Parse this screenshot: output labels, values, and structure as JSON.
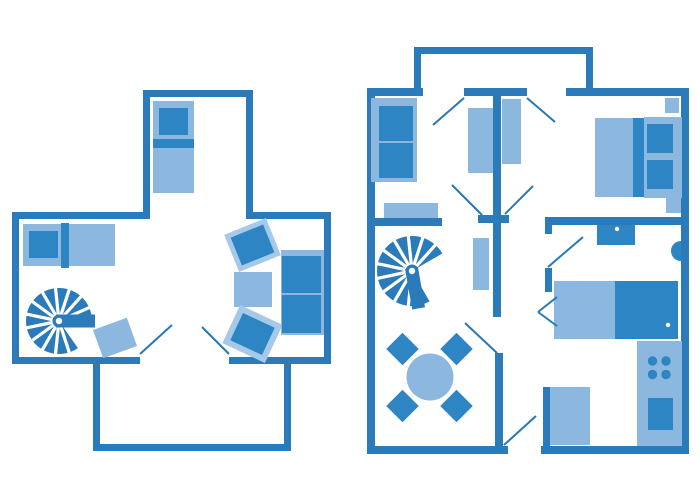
{
  "canvas": {
    "width": 700,
    "height": 500
  },
  "colors": {
    "background": "#ffffff",
    "wall": "#2b7ab9",
    "dark": "#2e85c3",
    "light": "#8cb8df",
    "lighter": "#a6c9e9",
    "line": "#2878b6",
    "white": "#ffffff"
  },
  "plans": [
    {
      "name": "left-unit-plan",
      "elements": [
        {
          "n": "wall-extension-top",
          "k": "wall",
          "x": 143,
          "y": 90,
          "w": 110,
          "h": 7
        },
        {
          "n": "wall-extension-left",
          "k": "wall",
          "x": 143,
          "y": 90,
          "w": 7,
          "h": 128
        },
        {
          "n": "wall-extension-right",
          "k": "wall",
          "x": 246,
          "y": 90,
          "w": 7,
          "h": 128
        },
        {
          "n": "wall-main-top-left",
          "k": "wall",
          "x": 12,
          "y": 212,
          "w": 138,
          "h": 7
        },
        {
          "n": "wall-main-top-right",
          "k": "wall",
          "x": 246,
          "y": 212,
          "w": 84,
          "h": 7
        },
        {
          "n": "wall-main-left",
          "k": "wall",
          "x": 12,
          "y": 212,
          "w": 7,
          "h": 152
        },
        {
          "n": "wall-main-right",
          "k": "wall",
          "x": 324,
          "y": 212,
          "w": 7,
          "h": 152
        },
        {
          "n": "wall-main-bottom-left",
          "k": "wall",
          "x": 12,
          "y": 357,
          "w": 128,
          "h": 7
        },
        {
          "n": "wall-main-bottom-right",
          "k": "wall",
          "x": 229,
          "y": 357,
          "w": 102,
          "h": 7
        },
        {
          "n": "wall-balcony-left",
          "k": "wall",
          "x": 93,
          "y": 357,
          "w": 7,
          "h": 94
        },
        {
          "n": "wall-balcony-bottom",
          "k": "wall",
          "x": 93,
          "y": 444,
          "w": 198,
          "h": 7
        },
        {
          "n": "wall-balcony-right",
          "k": "wall",
          "x": 284,
          "y": 357,
          "w": 7,
          "h": 94
        },
        {
          "n": "single-bed-base",
          "k": "rect",
          "c": "light",
          "x": 153,
          "y": 101,
          "w": 41,
          "h": 92
        },
        {
          "n": "single-bed-pillow",
          "k": "rect",
          "c": "dark",
          "x": 159,
          "y": 108,
          "w": 29,
          "h": 27
        },
        {
          "n": "single-bed-band",
          "k": "rect",
          "c": "dark",
          "x": 153,
          "y": 139,
          "w": 41,
          "h": 9
        },
        {
          "n": "daybed-base",
          "k": "rect",
          "c": "light",
          "x": 23,
          "y": 224,
          "w": 92,
          "h": 42
        },
        {
          "n": "daybed-pillow",
          "k": "rect",
          "c": "dark",
          "x": 29,
          "y": 231,
          "w": 29,
          "h": 27
        },
        {
          "n": "daybed-band",
          "k": "rect",
          "c": "dark",
          "x": 61,
          "y": 223,
          "w": 8,
          "h": 45
        },
        {
          "n": "spiral-staircase",
          "k": "stair",
          "cx": 59,
          "cy": 321,
          "r": 33,
          "bar": 0,
          "gap": [
            8,
            55
          ]
        },
        {
          "n": "rug",
          "k": "rect",
          "c": "light",
          "x": 97,
          "y": 323,
          "w": 36,
          "h": 30,
          "rot": -20
        },
        {
          "n": "armchair-top-frame",
          "k": "rect",
          "c": "lighter",
          "x": 230,
          "y": 225,
          "w": 45,
          "h": 40,
          "rot": -22
        },
        {
          "n": "armchair-top-seat",
          "k": "rect",
          "c": "dark",
          "x": 235,
          "y": 230,
          "w": 35,
          "h": 30,
          "rot": -22
        },
        {
          "n": "coffee-table",
          "k": "rect",
          "c": "light",
          "x": 234,
          "y": 272,
          "w": 38,
          "h": 35
        },
        {
          "n": "armchair-bottom-frame",
          "k": "rect",
          "c": "lighter",
          "x": 229,
          "y": 313,
          "w": 47,
          "h": 42,
          "rot": 25
        },
        {
          "n": "armchair-bottom-seat",
          "k": "rect",
          "c": "dark",
          "x": 235,
          "y": 319,
          "w": 35,
          "h": 30,
          "rot": 25
        },
        {
          "n": "sofa-base",
          "k": "rect",
          "c": "light",
          "x": 281,
          "y": 250,
          "w": 43,
          "h": 85
        },
        {
          "n": "sofa-cushion-top",
          "k": "rect",
          "c": "dark",
          "x": 282,
          "y": 256,
          "w": 39,
          "h": 37
        },
        {
          "n": "sofa-cushion-bottom",
          "k": "rect",
          "c": "dark",
          "x": 282,
          "y": 295,
          "w": 39,
          "h": 38
        },
        {
          "n": "door-swing-line",
          "k": "line",
          "x1": 140,
          "y1": 354,
          "x2": 172,
          "y2": 325
        },
        {
          "n": "door-swing-line",
          "k": "line",
          "x1": 202,
          "y1": 327,
          "x2": 229,
          "y2": 354
        }
      ]
    },
    {
      "name": "right-unit-plan",
      "elements": [
        {
          "n": "wall-porch-top",
          "k": "wall",
          "x": 414,
          "y": 47,
          "w": 179,
          "h": 7
        },
        {
          "n": "wall-porch-left",
          "k": "wall",
          "x": 414,
          "y": 47,
          "w": 7,
          "h": 49
        },
        {
          "n": "wall-porch-right",
          "k": "wall",
          "x": 586,
          "y": 47,
          "w": 7,
          "h": 49
        },
        {
          "n": "wall-top-a",
          "k": "wall",
          "x": 367,
          "y": 88,
          "w": 56,
          "h": 8
        },
        {
          "n": "wall-top-b",
          "k": "wall",
          "x": 464,
          "y": 88,
          "w": 63,
          "h": 8
        },
        {
          "n": "wall-top-c",
          "k": "wall",
          "x": 566,
          "y": 88,
          "w": 123,
          "h": 8
        },
        {
          "n": "wall-left",
          "k": "wall",
          "x": 367,
          "y": 88,
          "w": 8,
          "h": 366
        },
        {
          "n": "wall-right",
          "k": "wall",
          "x": 681,
          "y": 88,
          "w": 8,
          "h": 366
        },
        {
          "n": "wall-room1-bottom",
          "k": "wall",
          "x": 367,
          "y": 218,
          "w": 75,
          "h": 8
        },
        {
          "n": "wall-hall-vertical",
          "k": "wall",
          "x": 493,
          "y": 96,
          "w": 8,
          "h": 221
        },
        {
          "n": "wall-hall-stub",
          "k": "wall",
          "x": 478,
          "y": 215,
          "w": 31,
          "h": 8
        },
        {
          "n": "wall-bedroom-bottom",
          "k": "wall",
          "x": 545,
          "y": 217,
          "w": 137,
          "h": 8
        },
        {
          "n": "wall-bath-stub-top",
          "k": "wall",
          "x": 545,
          "y": 225,
          "w": 7,
          "h": 9
        },
        {
          "n": "wall-bath-stub",
          "k": "wall",
          "x": 545,
          "y": 268,
          "w": 7,
          "h": 24
        },
        {
          "n": "wall-kitchen-vertical",
          "k": "wall",
          "x": 495,
          "y": 353,
          "w": 8,
          "h": 93
        },
        {
          "n": "wall-bottom-a",
          "k": "wall",
          "x": 367,
          "y": 446,
          "w": 141,
          "h": 8
        },
        {
          "n": "wall-bottom-b",
          "k": "wall",
          "x": 541,
          "y": 446,
          "w": 148,
          "h": 8
        },
        {
          "n": "wall-wardrobe-stub",
          "k": "wall",
          "x": 543,
          "y": 387,
          "w": 7,
          "h": 59
        },
        {
          "n": "sofa2-base",
          "k": "rect",
          "c": "light",
          "x": 371,
          "y": 98,
          "w": 46,
          "h": 84
        },
        {
          "n": "sofa2-cushion-top",
          "k": "rect",
          "c": "dark",
          "x": 379,
          "y": 106,
          "w": 34,
          "h": 35
        },
        {
          "n": "sofa2-cushion-bottom",
          "k": "rect",
          "c": "dark",
          "x": 379,
          "y": 143,
          "w": 34,
          "h": 35
        },
        {
          "n": "bench",
          "k": "rect",
          "c": "light",
          "x": 384,
          "y": 203,
          "w": 54,
          "h": 15
        },
        {
          "n": "closet-left",
          "k": "rect",
          "c": "light",
          "x": 468,
          "y": 108,
          "w": 25,
          "h": 65
        },
        {
          "n": "closet-right",
          "k": "rect",
          "c": "light",
          "x": 502,
          "y": 99,
          "w": 19,
          "h": 65
        },
        {
          "n": "shelf",
          "k": "rect",
          "c": "light",
          "x": 473,
          "y": 238,
          "w": 16,
          "h": 52
        },
        {
          "n": "double-bed-mattress",
          "k": "rect",
          "c": "light",
          "x": 595,
          "y": 118,
          "w": 38,
          "h": 79
        },
        {
          "n": "double-bed-band",
          "k": "rect",
          "c": "dark",
          "x": 633,
          "y": 118,
          "w": 11,
          "h": 79
        },
        {
          "n": "double-bed-head",
          "k": "rect",
          "c": "light",
          "x": 644,
          "y": 117,
          "w": 38,
          "h": 81
        },
        {
          "n": "double-bed-pillow-top",
          "k": "rect",
          "c": "dark",
          "x": 647,
          "y": 124,
          "w": 26,
          "h": 29
        },
        {
          "n": "double-bed-pillow-bottom",
          "k": "rect",
          "c": "dark",
          "x": 647,
          "y": 160,
          "w": 26,
          "h": 29
        },
        {
          "n": "nightstand-top",
          "k": "rect",
          "c": "light",
          "x": 665,
          "y": 98,
          "w": 14,
          "h": 15
        },
        {
          "n": "nightstand-bottom",
          "k": "rect",
          "c": "light",
          "x": 666,
          "y": 198,
          "w": 15,
          "h": 15
        },
        {
          "n": "bath-sink",
          "k": "rect",
          "c": "dark",
          "x": 597,
          "y": 225,
          "w": 38,
          "h": 20
        },
        {
          "n": "bath-sink-dot",
          "k": "circle",
          "c": "white",
          "cx": 617,
          "cy": 229,
          "r": 2.2
        },
        {
          "n": "toilet",
          "k": "semi",
          "cx": 681,
          "cy": 251,
          "r": 10
        },
        {
          "n": "bathtub-deck",
          "k": "rect",
          "c": "light",
          "x": 554,
          "y": 281,
          "w": 61,
          "h": 58
        },
        {
          "n": "bathtub-basin",
          "k": "rect",
          "c": "dark",
          "x": 615,
          "y": 281,
          "w": 63,
          "h": 58
        },
        {
          "n": "bathtub-drain",
          "k": "circle",
          "c": "white",
          "cx": 668,
          "cy": 325,
          "r": 2.2
        },
        {
          "n": "kitchen-counter",
          "k": "rect",
          "c": "light",
          "x": 637,
          "y": 341,
          "w": 45,
          "h": 105
        },
        {
          "n": "stove-burner",
          "k": "circle",
          "c": "dark",
          "cx": 652.5,
          "cy": 361,
          "r": 4.7
        },
        {
          "n": "stove-burner",
          "k": "circle",
          "c": "dark",
          "cx": 666,
          "cy": 361,
          "r": 4.7
        },
        {
          "n": "stove-burner",
          "k": "circle",
          "c": "dark",
          "cx": 652.5,
          "cy": 374.5,
          "r": 4.7
        },
        {
          "n": "stove-burner",
          "k": "circle",
          "c": "dark",
          "cx": 666,
          "cy": 374.5,
          "r": 4.7
        },
        {
          "n": "kitchen-sink",
          "k": "rect",
          "c": "dark",
          "x": 648,
          "y": 398,
          "w": 25,
          "h": 32
        },
        {
          "n": "wardrobe",
          "k": "rect",
          "c": "light",
          "x": 550,
          "y": 387,
          "w": 40,
          "h": 58
        },
        {
          "n": "spiral-staircase",
          "k": "stair",
          "cx": 412,
          "cy": 271,
          "r": 35,
          "bar": 80,
          "gap": [
            -30,
            60
          ]
        },
        {
          "n": "dining-table",
          "k": "circle",
          "c": "light",
          "cx": 430,
          "cy": 377,
          "r": 23.5
        },
        {
          "n": "dining-chair",
          "k": "rect",
          "c": "dark",
          "x": 391,
          "y": 337.5,
          "w": 23,
          "h": 23,
          "rot": 45
        },
        {
          "n": "dining-chair",
          "k": "rect",
          "c": "dark",
          "x": 445,
          "y": 337.5,
          "w": 23,
          "h": 23,
          "rot": 45
        },
        {
          "n": "dining-chair",
          "k": "rect",
          "c": "dark",
          "x": 391,
          "y": 394.5,
          "w": 23,
          "h": 23,
          "rot": 45
        },
        {
          "n": "dining-chair",
          "k": "rect",
          "c": "dark",
          "x": 445,
          "y": 394.5,
          "w": 23,
          "h": 23,
          "rot": 45
        },
        {
          "n": "door-swing-line",
          "k": "line",
          "x1": 433,
          "y1": 125,
          "x2": 464,
          "y2": 98
        },
        {
          "n": "door-swing-line",
          "k": "line",
          "x1": 527,
          "y1": 98,
          "x2": 555,
          "y2": 122
        },
        {
          "n": "door-swing-line",
          "k": "line",
          "x1": 452,
          "y1": 185,
          "x2": 482,
          "y2": 215
        },
        {
          "n": "door-swing-line",
          "k": "line",
          "x1": 533,
          "y1": 186,
          "x2": 505,
          "y2": 214
        },
        {
          "n": "door-swing-line",
          "k": "line",
          "x1": 548,
          "y1": 267,
          "x2": 583,
          "y2": 237
        },
        {
          "n": "door-swing-line",
          "k": "line",
          "x1": 557,
          "y1": 297,
          "x2": 538,
          "y2": 312
        },
        {
          "n": "door-swing-line",
          "k": "line",
          "x1": 538,
          "y1": 312,
          "x2": 557,
          "y2": 326
        },
        {
          "n": "door-swing-line",
          "k": "line",
          "x1": 465,
          "y1": 323,
          "x2": 497,
          "y2": 353
        },
        {
          "n": "door-swing-line",
          "k": "line",
          "x1": 504,
          "y1": 445,
          "x2": 536,
          "y2": 416
        }
      ]
    }
  ]
}
